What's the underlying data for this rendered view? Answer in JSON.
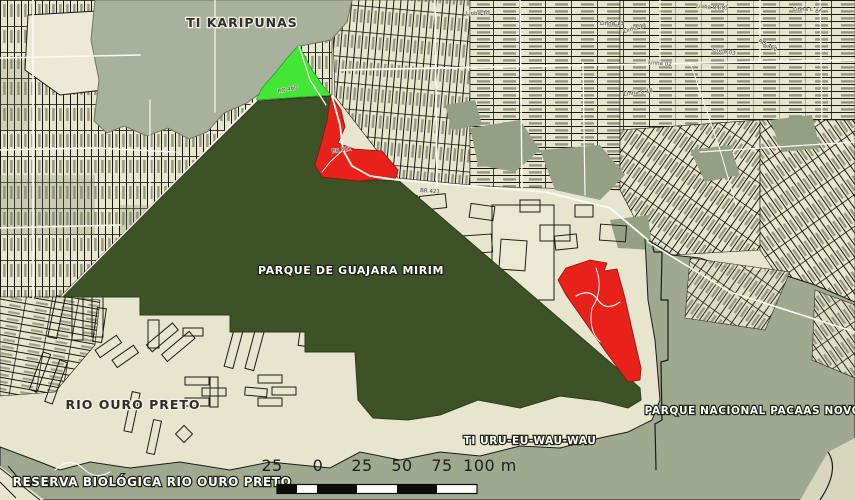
{
  "map": {
    "labels": {
      "ti_karipunas": "TI KARIPUNAS",
      "parque_guajara_mirim": "PARQUE DE GUAJARA MIRIM",
      "rio_ouro_preto": "RIO OURO PRETO",
      "reserva_biologica": "RESERVA BIOLÓGICA RIO OURO PRETO",
      "ti_uru_eu_wau_wau": "TI URU-EU-WAU-WAU",
      "parque_nacional_pacaas_novos": "PARQUE NACIONAL PACAAS NOVOS"
    },
    "road_labels": [
      "RO 460",
      "BR 421",
      "BR 421",
      "Linha 04/05",
      "Linha C 12",
      "Linha 11",
      "Linha 02",
      "Linha 03",
      "RO 460",
      "Linha 13",
      "Linha 10",
      "Linha C 18"
    ],
    "scale_bar": {
      "labels": [
        "25",
        "0",
        "25",
        "50",
        "75",
        "100 m"
      ],
      "unit": "m"
    },
    "colors": {
      "park_green": "#3d5226",
      "highlight_green": "#44e636",
      "alert_red": "#e8211b",
      "parcel_beige": "#e8e5cf",
      "protected_gray_north": "#a8b19b",
      "protected_gray_south": "#9fa98f",
      "forest_patch": "#93a084",
      "road_white": "#fbfaf1",
      "outline_black": "#1a1a1a"
    }
  }
}
